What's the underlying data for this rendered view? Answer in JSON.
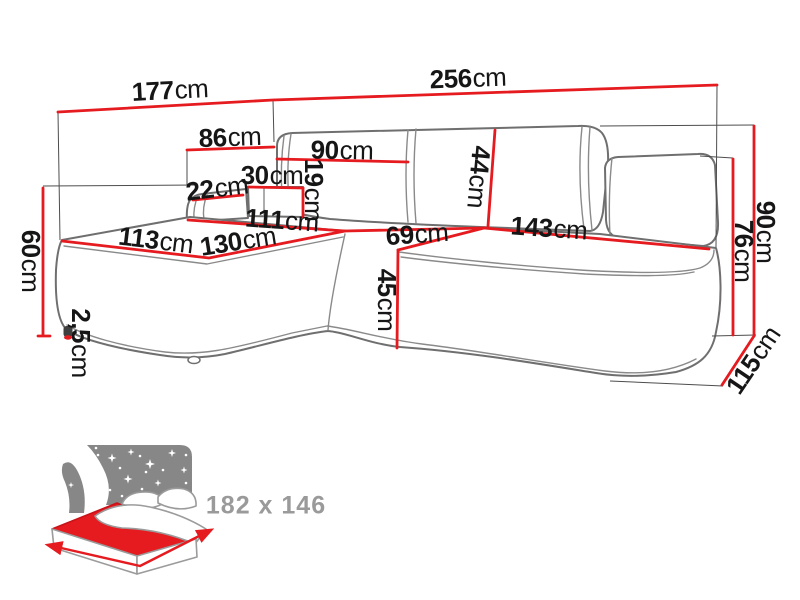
{
  "diagram_type": "corner-sofa-dimension-diagram",
  "unit": "cm",
  "labels": {
    "l177": {
      "num": "177",
      "unit": "cm"
    },
    "l256": {
      "num": "256",
      "unit": "cm"
    },
    "l86": {
      "num": "86",
      "unit": "cm"
    },
    "l90_top": {
      "num": "90",
      "unit": "cm"
    },
    "l30": {
      "num": "30",
      "unit": "cm"
    },
    "l19": {
      "num": "19",
      "unit": "cm"
    },
    "l22": {
      "num": "22",
      "unit": "cm"
    },
    "l44": {
      "num": "44",
      "unit": "cm"
    },
    "l111": {
      "num": "111",
      "unit": "cm"
    },
    "l113": {
      "num": "113",
      "unit": "cm"
    },
    "l130": {
      "num": "130",
      "unit": "cm"
    },
    "l69": {
      "num": "69",
      "unit": "cm"
    },
    "l143": {
      "num": "143",
      "unit": "cm"
    },
    "l45": {
      "num": "45",
      "unit": "cm"
    },
    "l60": {
      "num": "60",
      "unit": "cm"
    },
    "l2_5": {
      "num": "2,5",
      "unit": "cm"
    },
    "l76": {
      "num": "76",
      "unit": "cm"
    },
    "l90_right": {
      "num": "90",
      "unit": "cm"
    },
    "l115": {
      "num": "115",
      "unit": "cm"
    }
  },
  "sleeping_area": {
    "label": "182 x 146"
  },
  "colors": {
    "measure_red": "#e51b20",
    "outline_gray": "#6f6f6f",
    "extension_gray": "#4d4d4d",
    "text_black": "#161616",
    "icon_gray": "#878787",
    "icon_text_gray": "#9a9a9a"
  }
}
